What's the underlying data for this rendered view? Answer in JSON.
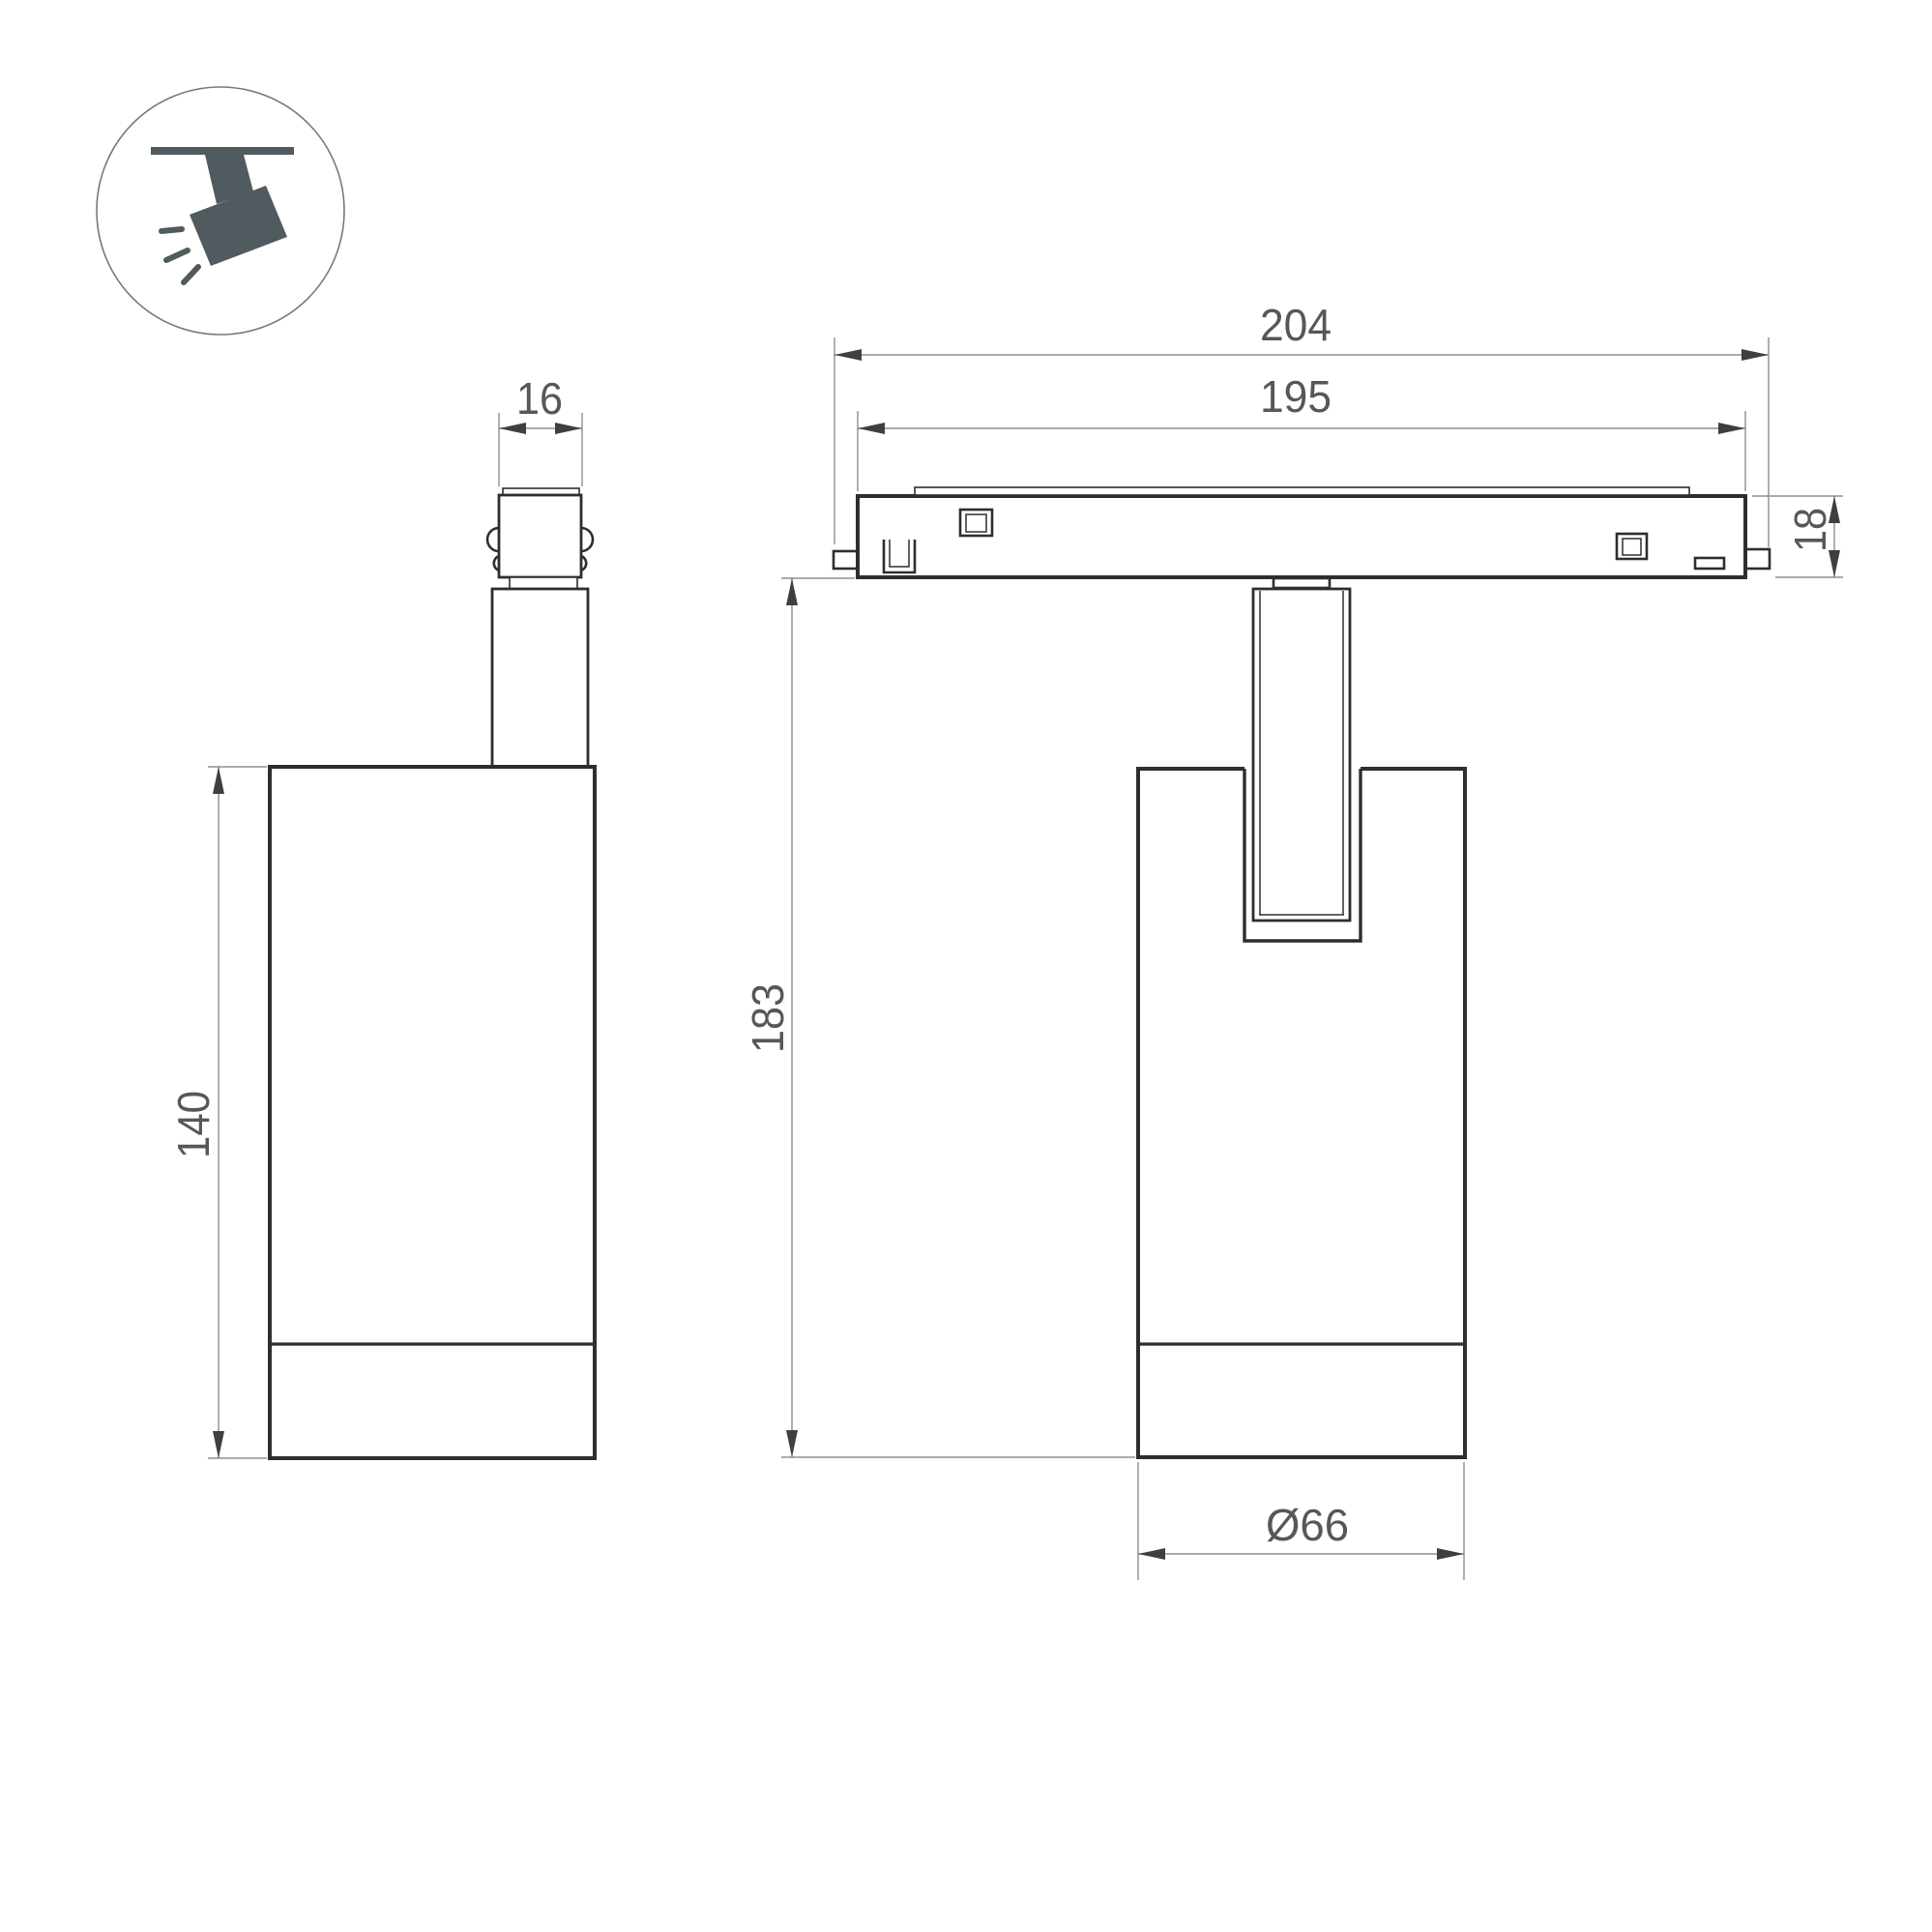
{
  "drawing": {
    "title": "Magnetic track spotlight dimension drawing",
    "background": "#ffffff",
    "legend_icon": "track-spotlight-icon",
    "views": {
      "side": {
        "labels": {
          "adapter_width": "16",
          "body_height": "140"
        }
      },
      "front": {
        "labels": {
          "overall_length": "204",
          "track_length": "195",
          "track_height": "18",
          "overall_height": "183",
          "body_diameter": "Ø66"
        }
      }
    },
    "colors": {
      "outline": "#2c2e30",
      "dimension_line": "#8f8f8f",
      "dimension_text": "#55585a",
      "arrow": "#3d3f41",
      "icon": "#515a5e"
    }
  }
}
